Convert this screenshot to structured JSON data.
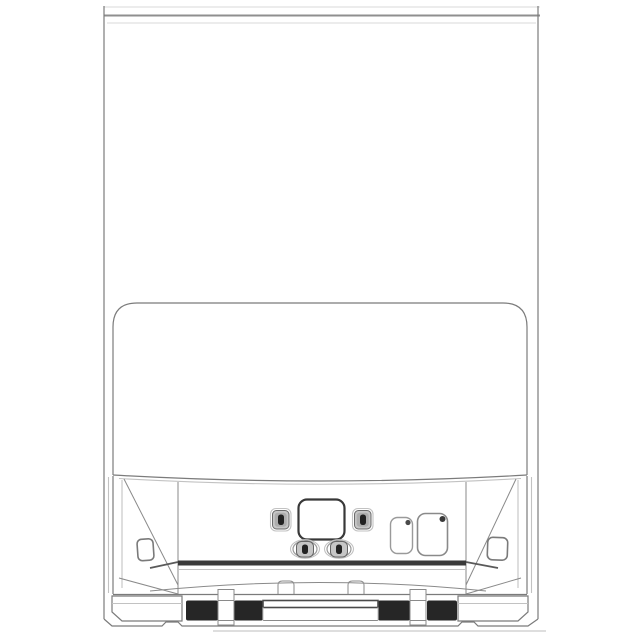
{
  "meta": {
    "description": "Technical line drawing: front view of a floor-standing appliance with an open lower service compartment",
    "background": "#ffffff"
  },
  "colors": {
    "line_main": "#7b7b7b",
    "line_dark": "#3f3f3f",
    "line_light": "#c2c2c2",
    "line_faint": "#e0e0e0",
    "roller_fill": "#262626",
    "button_fill": "#c6c6c6",
    "button_slot_fill": "#222222",
    "rail_fill": "#3a3a3a",
    "panel_fill": "#ffffff"
  },
  "parts": {
    "cabinet": "outer cabinet body",
    "top_lid": "thin top lid seam",
    "hood_panel": "large front hood panel with rounded top corners",
    "interior": "open lower compartment with perspective side walls",
    "display_window": "central rounded display window",
    "lock_buttons": [
      "left slotted button",
      "right slotted button"
    ],
    "capsule_buttons": [
      "left oval slotted button",
      "right oval slotted button"
    ],
    "right_panels": [
      "small rounded cover plate",
      "large rounded cover plate"
    ],
    "wall_plates": [
      "left side-wall plate",
      "right side-wall plate"
    ],
    "rail": "dark horizontal support rail",
    "sill": "curved lower sill",
    "clips": [
      "left mounting clip",
      "right mounting clip"
    ],
    "base": {
      "feet": [
        "left levelling foot block",
        "right levelling foot block"
      ],
      "rollers": [
        "left roller pair",
        "right roller pair"
      ],
      "brackets": [
        "left roller bracket",
        "right roller bracket"
      ],
      "center_bar": "central base cross-bar"
    },
    "shadow": "floor shadow line"
  },
  "counts": {
    "buttons": 4,
    "rollers": 4,
    "cover_plates": 2,
    "wall_plates": 2
  }
}
